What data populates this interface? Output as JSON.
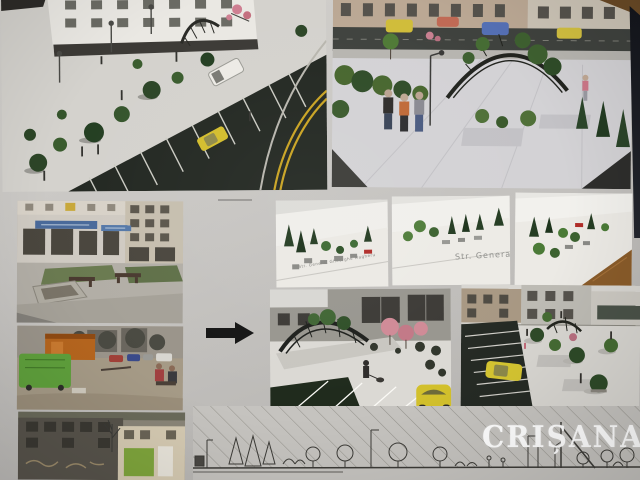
{
  "board": {
    "background_color": "#c6c4c1",
    "arrow": {
      "direction": "right",
      "color": "#141414"
    },
    "labels": {
      "model_left_street": "Str. General Gheorghe Magheru",
      "model_center_street": "Str. Genera"
    },
    "watermark": {
      "text": "CRIȘANA",
      "color": "#ffffff"
    },
    "panels": [
      {
        "name": "render-aerial-parking-plaza",
        "type": "3d-render"
      },
      {
        "name": "render-street-level-plaza",
        "type": "3d-render"
      },
      {
        "name": "photo-existing-shops-benches",
        "type": "site-photo"
      },
      {
        "name": "photo-existing-dumpster-kiosk",
        "type": "site-photo"
      },
      {
        "name": "photo-existing-building-facade",
        "type": "site-photo"
      },
      {
        "name": "model-maquette-left",
        "type": "model-photo"
      },
      {
        "name": "model-maquette-center",
        "type": "model-photo"
      },
      {
        "name": "model-maquette-right",
        "type": "model-photo"
      },
      {
        "name": "render-plaza-pergola",
        "type": "3d-render"
      },
      {
        "name": "render-aerial-yellow-car",
        "type": "3d-render"
      },
      {
        "name": "elevation-line-drawing",
        "type": "drawing"
      }
    ],
    "colors": {
      "asphalt": "#232822",
      "pavement": "#d4d2cd",
      "tree_green": "#2c4527",
      "taxi_yellow": "#d3bd2c",
      "road_line_yellow": "#c9a322",
      "dumpster_green": "#5fa03c",
      "kiosk_orange": "#b55a1a",
      "pink_blossom": "#cf8a96",
      "table_wood": "#8a5c2a"
    }
  }
}
